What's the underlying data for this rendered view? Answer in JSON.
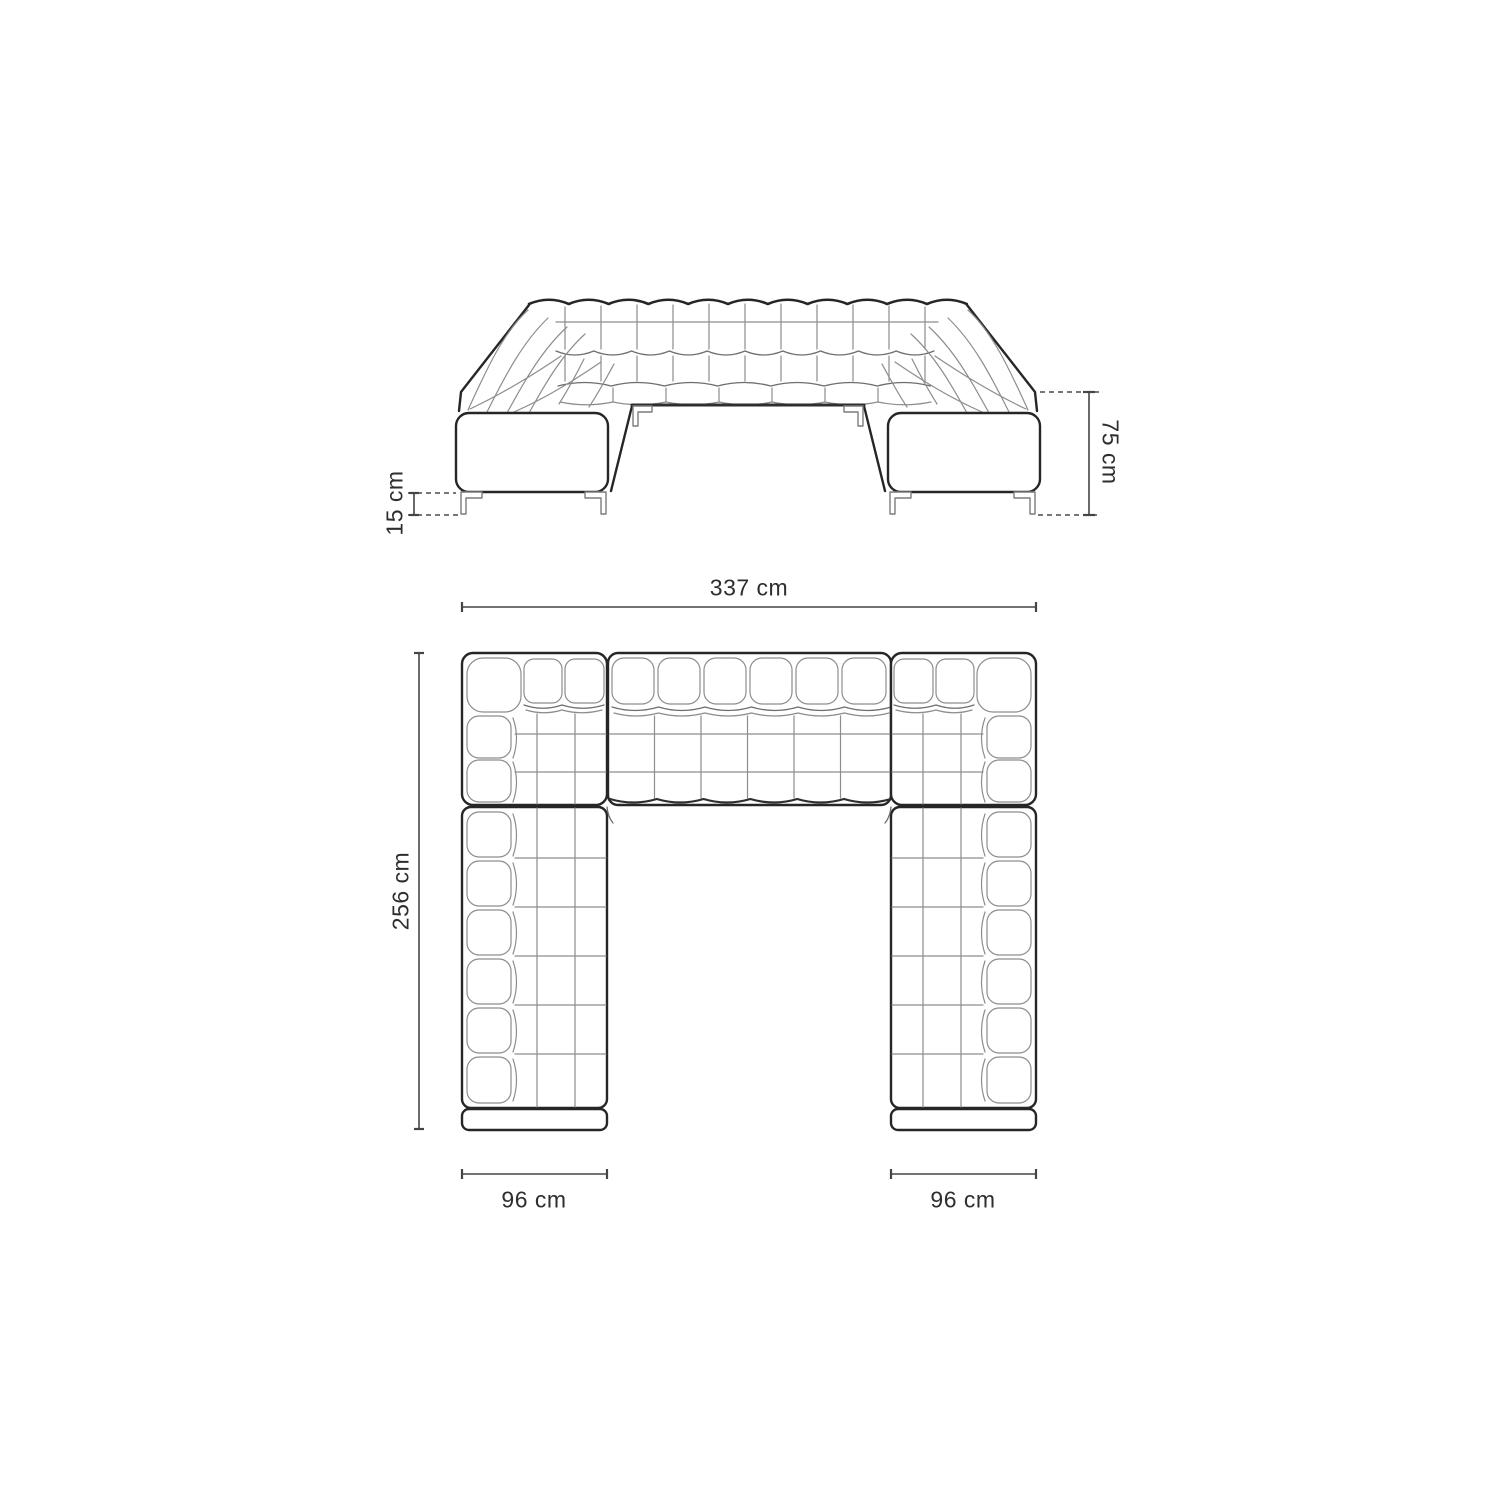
{
  "page": {
    "background": "#ffffff"
  },
  "diagram": {
    "type": "furniture-dimension-drawing",
    "subject": "u-shaped-modular-tufted-sofa",
    "views": [
      {
        "id": "front",
        "name": "front-elevation"
      },
      {
        "id": "plan",
        "name": "top-plan"
      }
    ],
    "dimensions": {
      "front_height": {
        "label": "75 cm",
        "orientation": "vertical"
      },
      "front_leg_height": {
        "label": "15 cm",
        "orientation": "vertical"
      },
      "plan_width": {
        "label": "337 cm",
        "orientation": "horizontal"
      },
      "plan_depth": {
        "label": "256 cm",
        "orientation": "vertical"
      },
      "plan_left_arm": {
        "label": "96 cm",
        "orientation": "horizontal"
      },
      "plan_right_arm": {
        "label": "96 cm",
        "orientation": "horizontal"
      }
    },
    "colors": {
      "outline": "#262626",
      "tuft_line": "#8d8d8d",
      "dimension_line": "#454545",
      "text": "#2e2e2e",
      "background": "#ffffff"
    }
  }
}
